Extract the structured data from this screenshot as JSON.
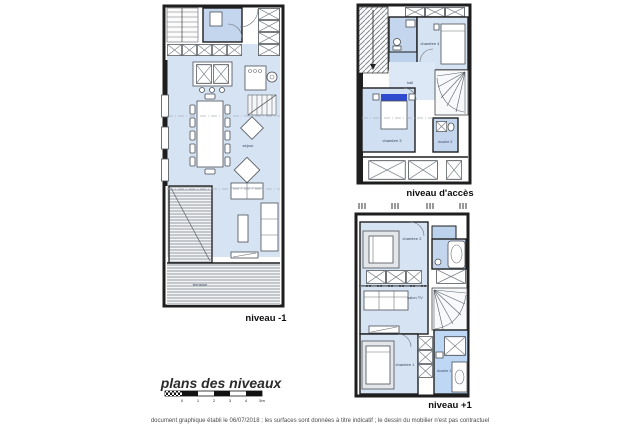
{
  "page": {
    "footer": "document graphique établi le 06/07/2018 ; les surfaces sont données à titre indicatif ; le dessin du mobilier n'est pas contractuel"
  },
  "title_block": {
    "title": "plans des niveaux",
    "scale_ticks": [
      "0",
      "1",
      "2",
      "3",
      "4",
      "5m"
    ]
  },
  "plans": {
    "minus1": {
      "label": "niveau -1",
      "rooms": {
        "sejour": "séjour",
        "terrasse": "terrasse"
      }
    },
    "access": {
      "label": "niveau d'accès",
      "rooms": {
        "hall": "hall",
        "chambre4": "chambre 4",
        "chambre3": "chambre 3",
        "douche3": "douche 3"
      }
    },
    "plus1": {
      "label": "niveau +1",
      "rooms": {
        "chambre2": "chambre 2",
        "salon_tv": "salon TV",
        "chambre1": "chambre 1",
        "douche1": "douche 1"
      }
    }
  },
  "colors": {
    "floor": "#d6e3f3",
    "floor_dark": "#c3d6ee",
    "accent": "#2e4bcf",
    "wall": "#1e1e1e"
  }
}
